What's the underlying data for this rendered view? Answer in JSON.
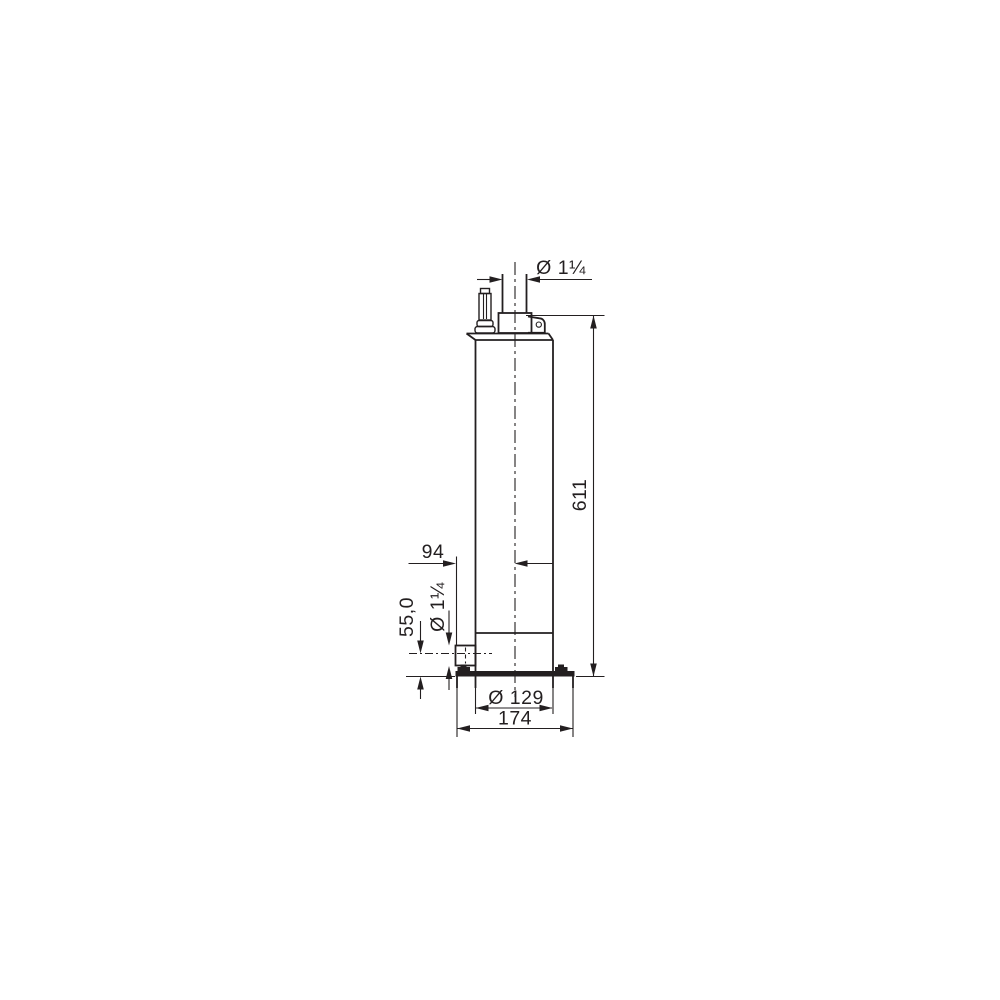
{
  "drawing": {
    "line_color": "#231f20",
    "background_color": "#ffffff",
    "labels": {
      "outlet_diameter": "Ø 1¼",
      "overall_height": "611",
      "port_center_offset": "94",
      "port_axis_height": "55,0",
      "port_diameter": "Ø 1¼",
      "body_diameter": "Ø 129",
      "base_width": "174"
    }
  }
}
